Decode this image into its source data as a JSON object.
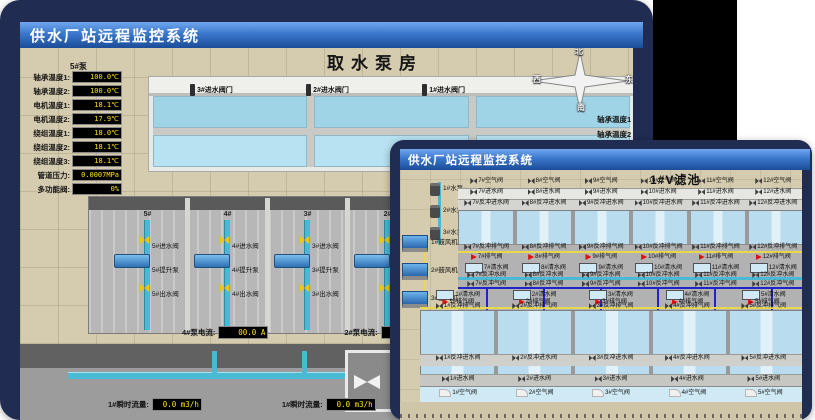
{
  "back_window": {
    "titlebar": "供水厂站远程监控系统",
    "scene_title": "取水泵房",
    "pump_panel": {
      "header": "5#泵",
      "rows": [
        {
          "label": "轴承温度1:",
          "value": "100.0℃"
        },
        {
          "label": "轴承温度2:",
          "value": "100.0℃"
        },
        {
          "label": "电机温度1:",
          "value": "18.1℃"
        },
        {
          "label": "电机温度2:",
          "value": "17.9℃"
        },
        {
          "label": "绕组温度1:",
          "value": "18.0℃"
        },
        {
          "label": "绕组温度2:",
          "value": "18.1℃"
        },
        {
          "label": "绕组温度3:",
          "value": "18.1℃"
        },
        {
          "label": "管道压力:",
          "value": "0.0007MPa"
        },
        {
          "label": "多功能阀:",
          "value": "0%"
        }
      ]
    },
    "inlet_valve_labels": [
      "3#进水阀门",
      "2#进水阀门",
      "1#进水阀门"
    ],
    "compass": {
      "north": "北",
      "west": "西",
      "south": "南",
      "east": "东"
    },
    "right_panel_partial": [
      "轴承温度1",
      "轴承温度2"
    ],
    "pump_bays": [
      {
        "bay": "5#",
        "valve_in": "5#进水阀",
        "pump": "5#提升泵",
        "valve_out": "5#出水阀"
      },
      {
        "bay": "4#",
        "valve_in": "4#进水阀",
        "pump": "4#提升泵",
        "valve_out": "4#出水阀"
      },
      {
        "bay": "3#",
        "valve_in": "3#进水阀",
        "pump": "3#提升泵",
        "valve_out": "3#出水阀"
      },
      {
        "bay": "2#",
        "valve_in": "2#进水阀",
        "pump": "2#提升泵",
        "valve_out": "2#出水阀"
      }
    ],
    "current_readouts": [
      {
        "label": "4#泵电流:",
        "value": "00.0 A"
      },
      {
        "label": "2#泵电流:",
        "value": "00.0 A"
      }
    ],
    "flow_readouts": [
      {
        "label": "1#瞬时流量:",
        "value": "0.0 m3/h"
      },
      {
        "label": "1#瞬时流量:",
        "value": "0.0 m3/h"
      }
    ]
  },
  "front_window": {
    "titlebar": "供水厂站远程监控系统",
    "scene_title": "1#V滤池",
    "left_equipment": {
      "pumps": [
        "1#水泵",
        "2#水泵",
        "3#水泵"
      ],
      "blowers": [
        "1#鼓风机",
        "2#鼓风机",
        "3#鼓风机"
      ]
    },
    "top_pools": {
      "air_valves": [
        "7#空气阀",
        "8#空气阀",
        "9#空气阀",
        "10#空气阀",
        "11#空气阀",
        "12#空气阀"
      ],
      "inlet_valves": [
        "7#进水阀",
        "8#进水阀",
        "9#进水阀",
        "10#进水阀",
        "11#进水阀",
        "12#进水阀"
      ],
      "backwash_inlet_valves": [
        "7#反冲进水阀",
        "8#反冲进水阀",
        "9#反冲进水阀",
        "10#反冲进水阀",
        "11#反冲进水阀",
        "12#反冲进水阀"
      ],
      "backwash_vent_valves": [
        "7#反冲排气阀",
        "8#反冲排气阀",
        "9#反冲排气阀",
        "10#反冲排气阀",
        "11#反冲排气阀",
        "12#反冲排气阀"
      ],
      "vent_valves": [
        "7#排气阀",
        "8#排气阀",
        "9#排气阀",
        "10#排气阀",
        "11#排气阀",
        "12#排气阀"
      ],
      "clean_water_valves": [
        "7#清水阀",
        "8#清水阀",
        "9#清水阀",
        "10#清水阀",
        "11#清水阀",
        "12#清水阀"
      ],
      "backwash_water_valves": [
        "7#反冲水阀",
        "8#反冲水阀",
        "9#反冲水阀",
        "10#反冲水阀",
        "11#反冲水阀",
        "12#反冲水阀"
      ],
      "backwash_air_valves": [
        "7#反冲气阀",
        "8#反冲气阀",
        "9#反冲气阀",
        "10#反冲气阀",
        "11#反冲气阀",
        "12#反冲气阀"
      ]
    },
    "bottom_pools": {
      "clean_water_valves": [
        "1#清水阀",
        "2#清水阀",
        "3#清水阀",
        "4#清水阀",
        "5#清水阀"
      ],
      "vent_valves": [
        "1#排气阀",
        "2#排气阀",
        "3#排气阀",
        "4#排气阀",
        "5#排气阀"
      ],
      "backwash_vent_valves": [
        "1#反冲排气阀",
        "2#反冲排气阀",
        "3#反冲排气阀",
        "4#反冲排气阀",
        "5#反冲排气阀"
      ],
      "backwash_inlet_valves": [
        "1#反冲进水阀",
        "2#反冲进水阀",
        "3#反冲进水阀",
        "4#反冲进水阀",
        "5#反冲进水阀"
      ],
      "inlet_valves": [
        "1#进水阀",
        "2#进水阀",
        "3#进水阀",
        "4#进水阀",
        "5#进水阀"
      ],
      "air_valves": [
        "1#空气阀",
        "2#空气阀",
        "3#空气阀",
        "4#空气阀",
        "5#空气阀"
      ]
    }
  },
  "colors": {
    "card_navy": "#202c52",
    "titlebar_top": "#71a7ee",
    "titlebar_bottom": "#1b4c97",
    "scada_tan": "#d5ccb0",
    "lcd_bg": "#000000",
    "lcd_text": "#ffe400",
    "water_deep": "#9fd4e6",
    "water_light": "#b9dcee",
    "pipe_cyan": "#4ab9d4",
    "pipe_navy": "#2224c8",
    "pipe_yellow": "#e8d84e",
    "flag_red": "#e01010",
    "backdrop_black": "#000000"
  }
}
